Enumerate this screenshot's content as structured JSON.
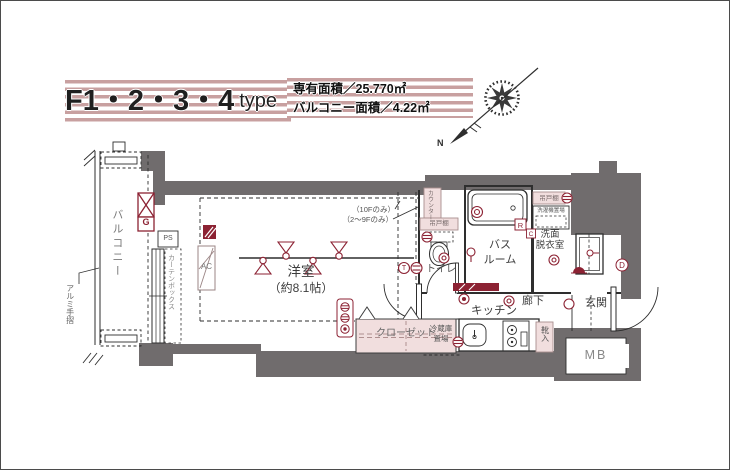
{
  "header": {
    "title_main": "F1・2・3・4",
    "title_suffix": "type",
    "area_line1": "専有面積／25.770㎡",
    "area_line2": "バルコニー面積／4.22㎡"
  },
  "compass": {
    "north": "N"
  },
  "rooms": {
    "balcony": "バルコニー",
    "western_room": "洋室",
    "western_room_size": "（約8.1帖）",
    "toilet": "トイレ",
    "bath_1": "バス",
    "bath_2": "ルーム",
    "washroom_1": "洗面",
    "washroom_2": "脱衣室",
    "corridor": "廊下",
    "entrance": "玄関",
    "kitchen": "キッチン",
    "closet": "クローゼット",
    "fridge_1": "冷蔵庫",
    "fridge_2": "置場",
    "meter_box": "MB"
  },
  "fixtures": {
    "counter": "カウンター",
    "cupboard_toilet": "吊戸棚",
    "cupboard_wash": "吊戸棚",
    "washer": "洗濯機置場",
    "shoe_box": "靴入",
    "curtain_box": "カーテンボックス",
    "handrail": "アルミ手摺",
    "ac": "AC",
    "ps": "PS"
  },
  "badges": {
    "g": "G",
    "r": "R",
    "c": "C",
    "d": "D",
    "t": "T"
  },
  "notes": {
    "only_10f": "（10Fのみ）",
    "only_2_9f": "（2〜9Fのみ）"
  },
  "colors": {
    "wall_gray": "#706c6d",
    "fixture_pink": "#f1dede",
    "accent_maroon": "#8c2233",
    "stripe_mauve": "#c8a0a0"
  }
}
